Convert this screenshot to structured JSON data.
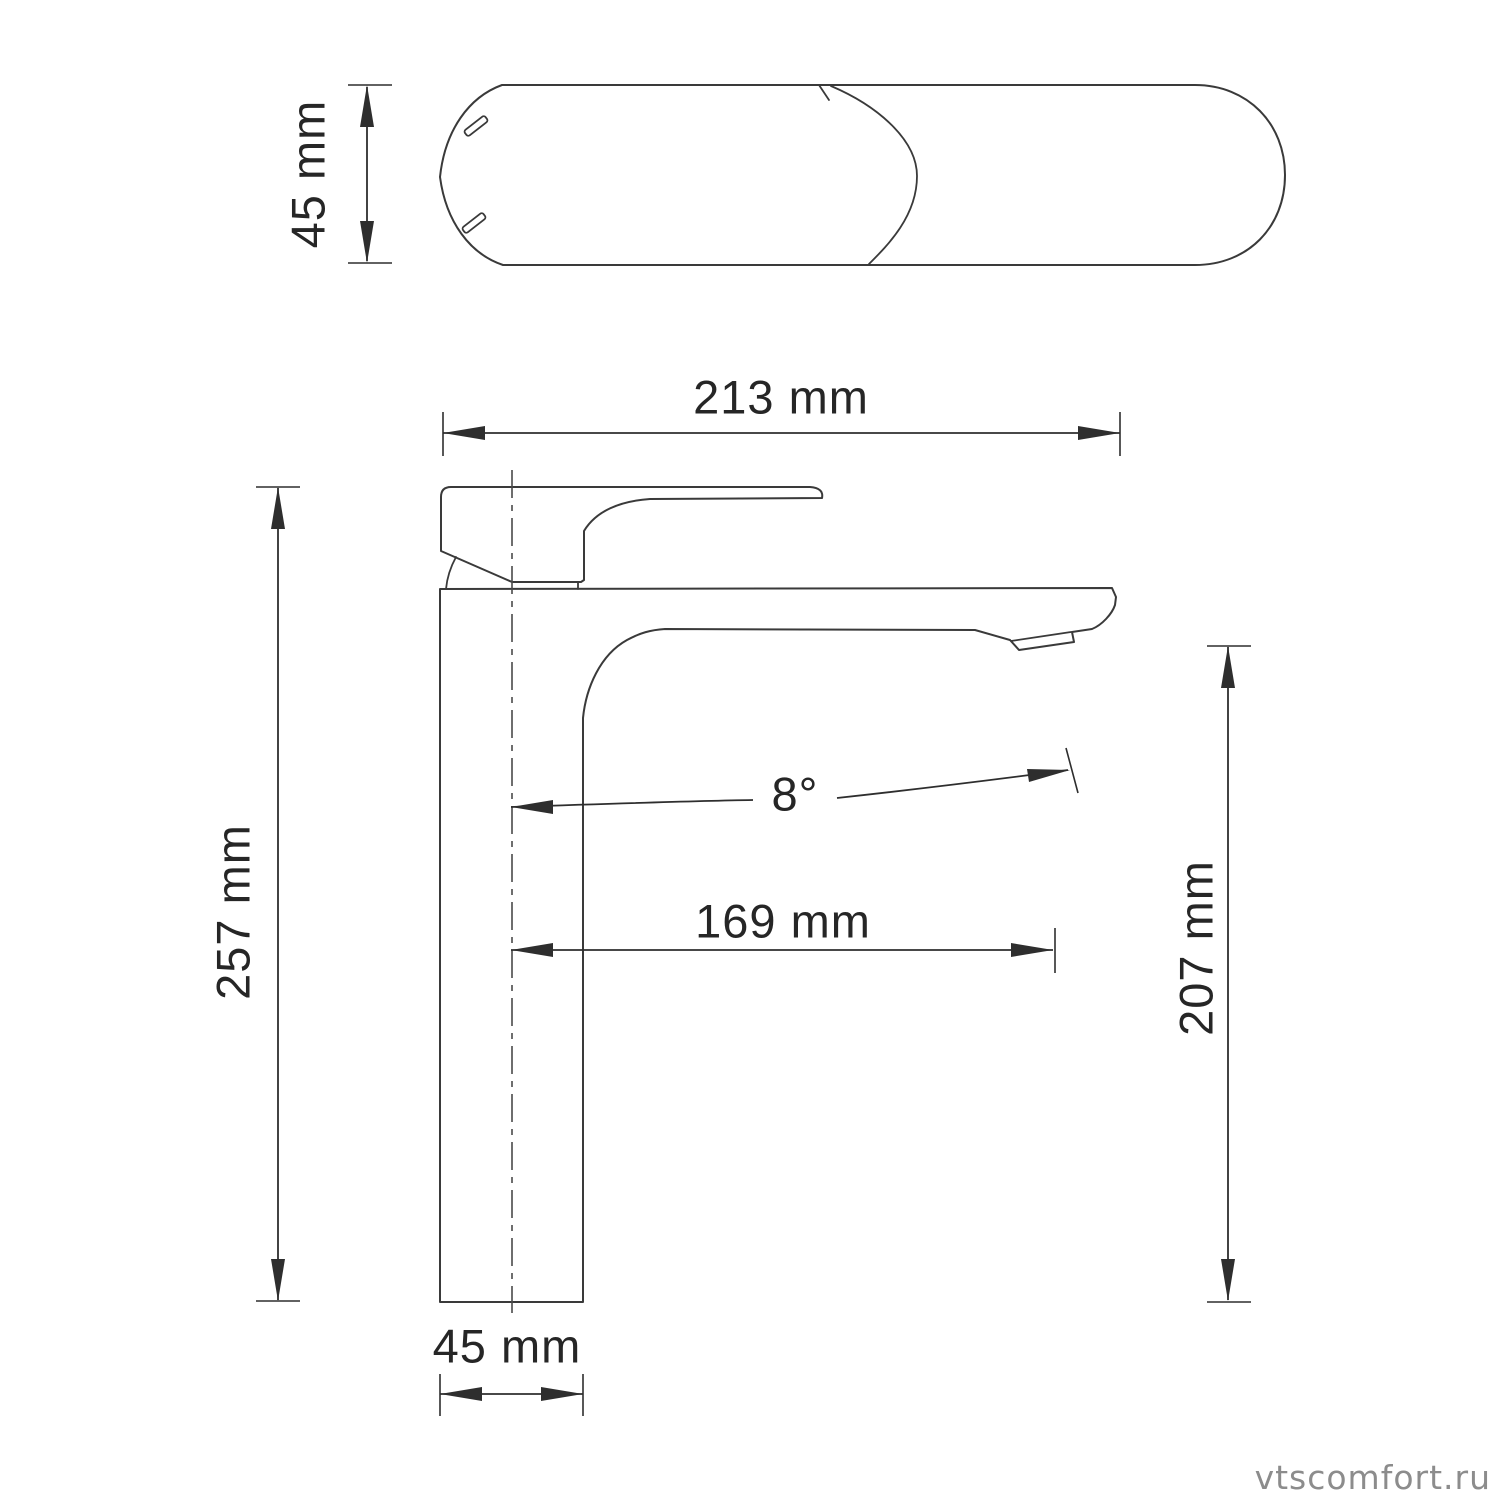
{
  "colors": {
    "background": "#ffffff",
    "ink": "#2e2e2e",
    "outline": "#3a3a3a",
    "watermark": "#8c8c8c"
  },
  "views": {
    "top_view": {
      "dims": {
        "body_height": {
          "label": "45 mm",
          "value": 45,
          "unit": "mm"
        }
      }
    },
    "side_view": {
      "dims": {
        "overall_length": {
          "label": "213 mm",
          "value": 213,
          "unit": "mm"
        },
        "overall_height": {
          "label": "257 mm",
          "value": 257,
          "unit": "mm"
        },
        "spout_angle": {
          "label": "8°",
          "value": 8,
          "unit": "deg"
        },
        "spout_reach": {
          "label": "169 mm",
          "value": 169,
          "unit": "mm"
        },
        "spout_height": {
          "label": "207 mm",
          "value": 207,
          "unit": "mm"
        },
        "base_width": {
          "label": "45 mm",
          "value": 45,
          "unit": "mm"
        }
      }
    }
  },
  "watermark": {
    "text": "vtscomfort.ru"
  }
}
